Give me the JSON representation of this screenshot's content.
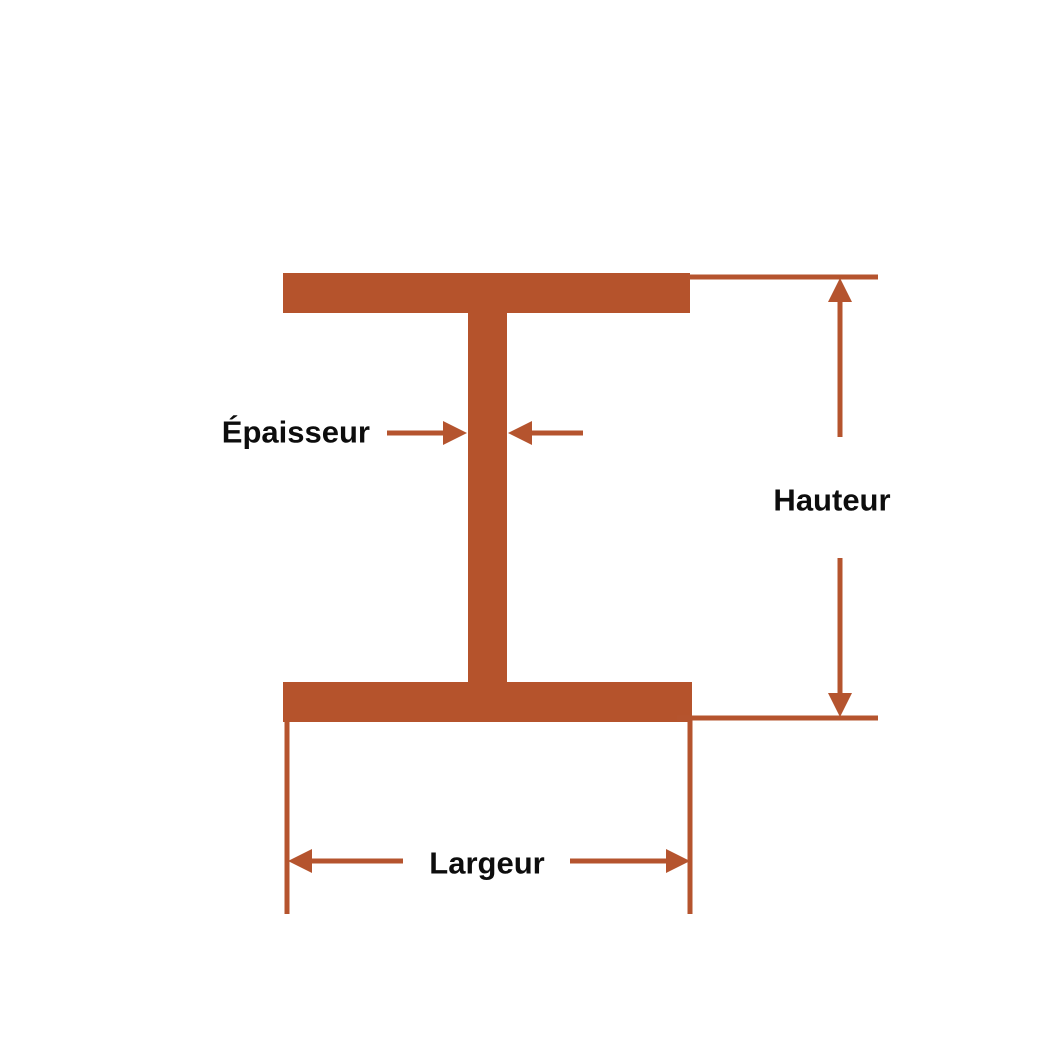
{
  "diagram": {
    "type": "i-beam-cross-section",
    "labels": {
      "epaisseur": "Épaisseur",
      "hauteur": "Hauteur",
      "largeur": "Largeur"
    },
    "colors": {
      "beam": "#B5532C",
      "line": "#B5542E",
      "text": "#0D0D0D",
      "background": "#FFFFFF"
    }
  }
}
